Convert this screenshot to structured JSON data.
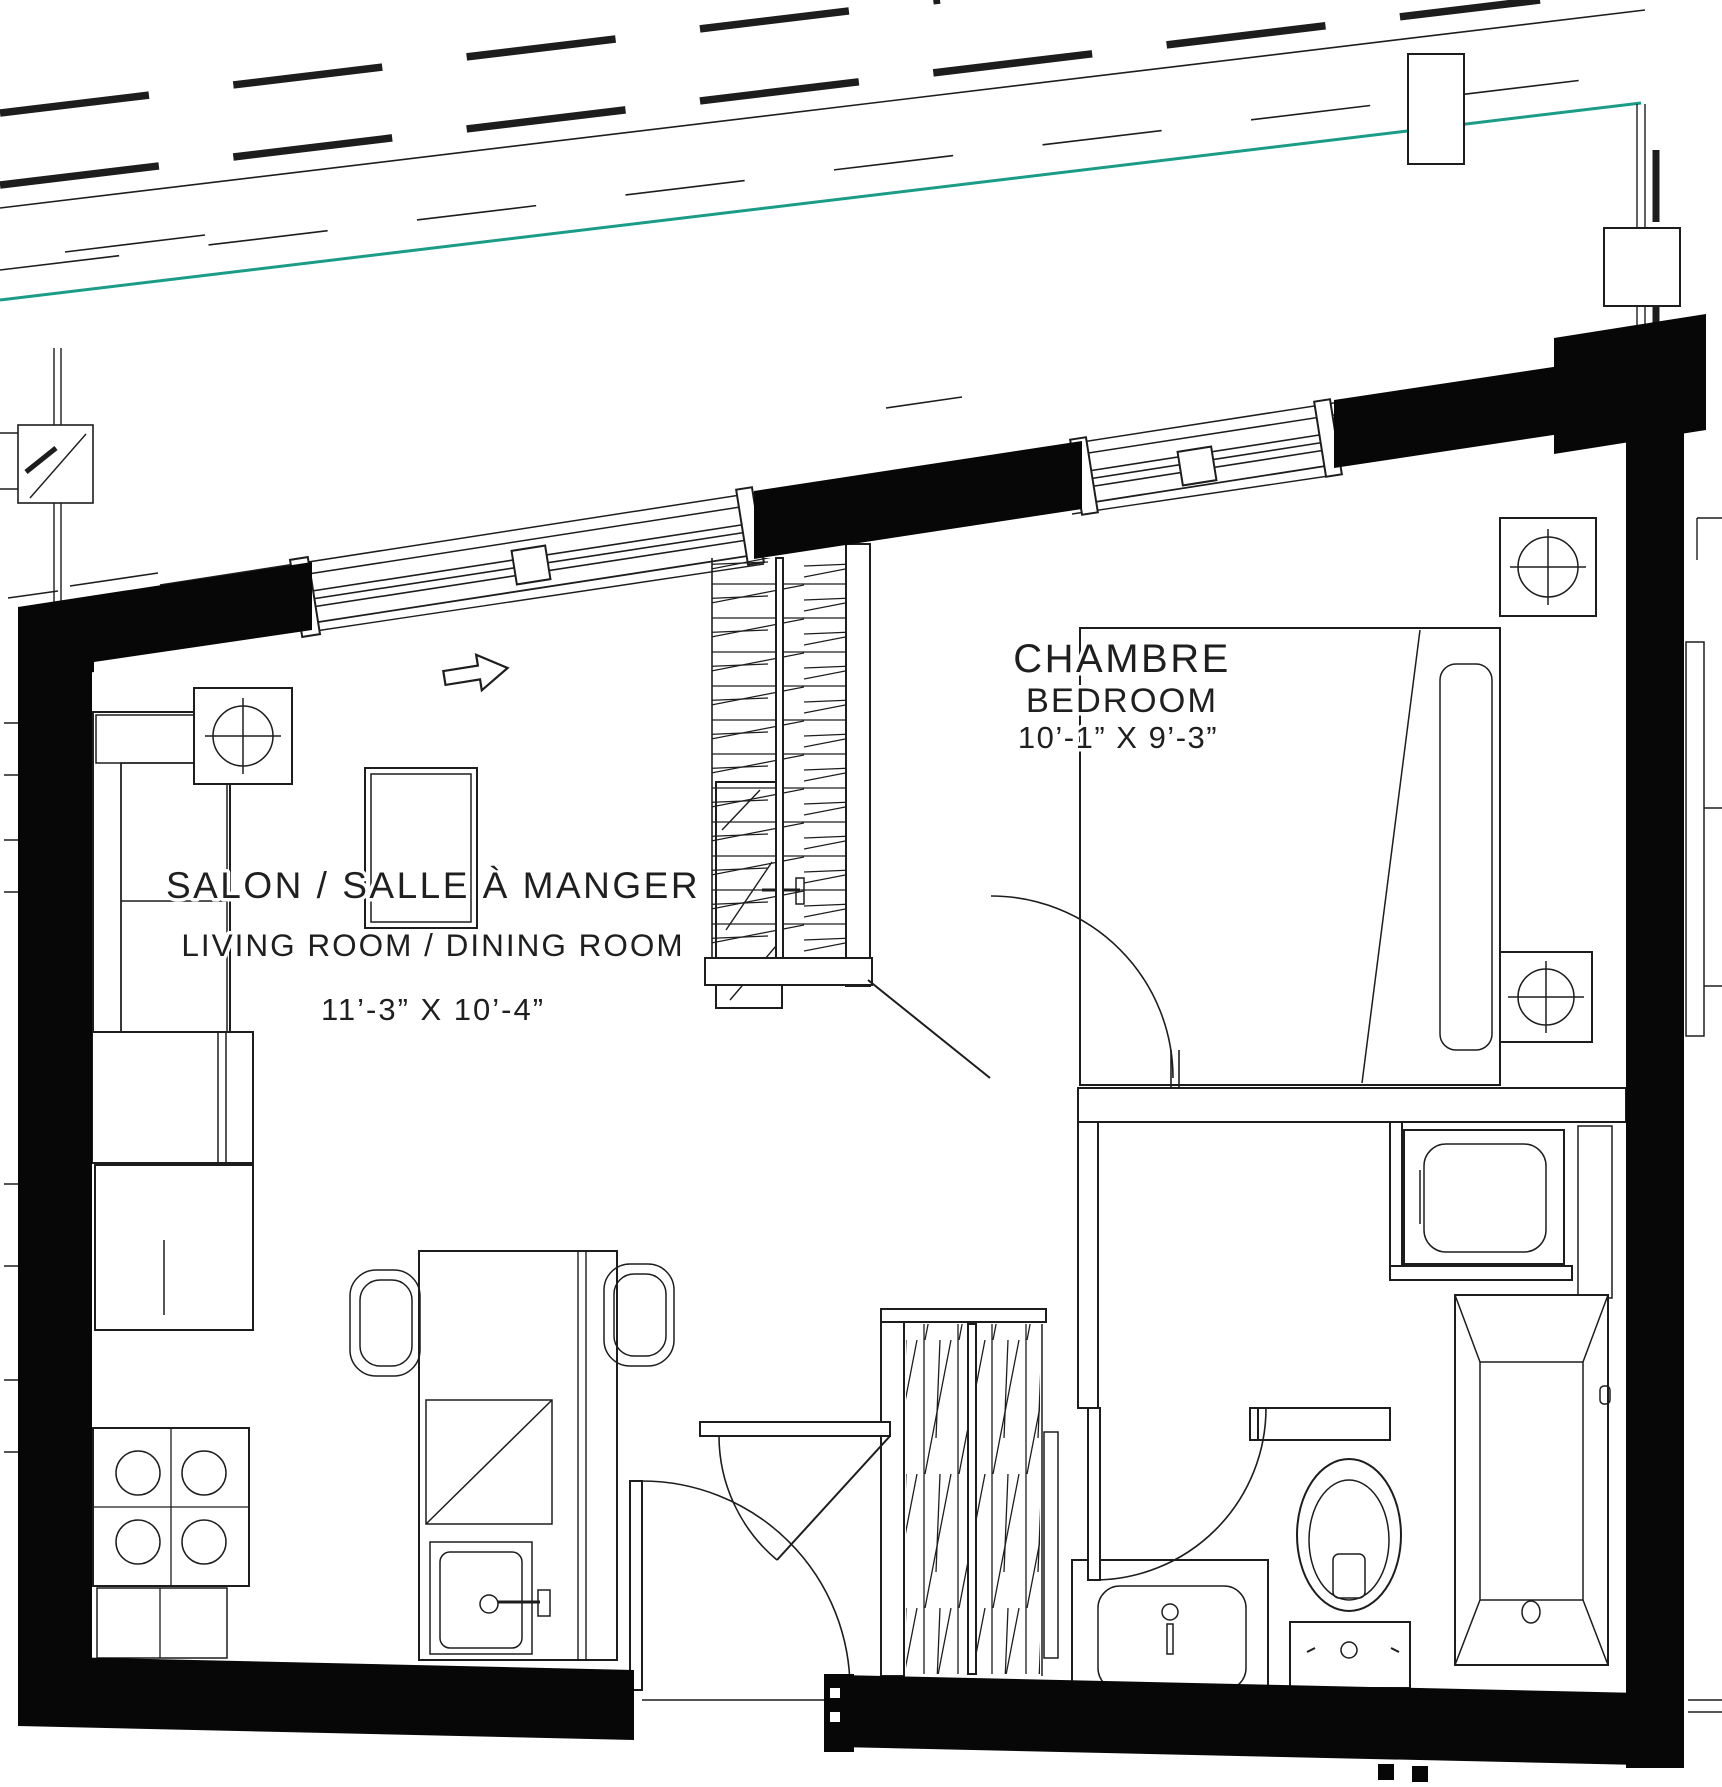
{
  "document": {
    "type": "architectural floor plan"
  },
  "rooms": {
    "living": {
      "title": "SALON / SALLE À MANGER",
      "subtitle": "LIVING ROOM / DINING ROOM",
      "dimensions": "11’-3” X 10’-4”"
    },
    "bedroom": {
      "title": "CHAMBRE",
      "subtitle": "BEDROOM",
      "dimensions": "10’-1” X 9’-3”"
    }
  },
  "colors": {
    "wall": "#070707",
    "line": "#1d1d1d",
    "property_line": "#1a9c86",
    "background": "#ffffff"
  },
  "icons": {
    "entry_arrow": "right-arrow",
    "lamp_symbol": "circle-cross"
  }
}
